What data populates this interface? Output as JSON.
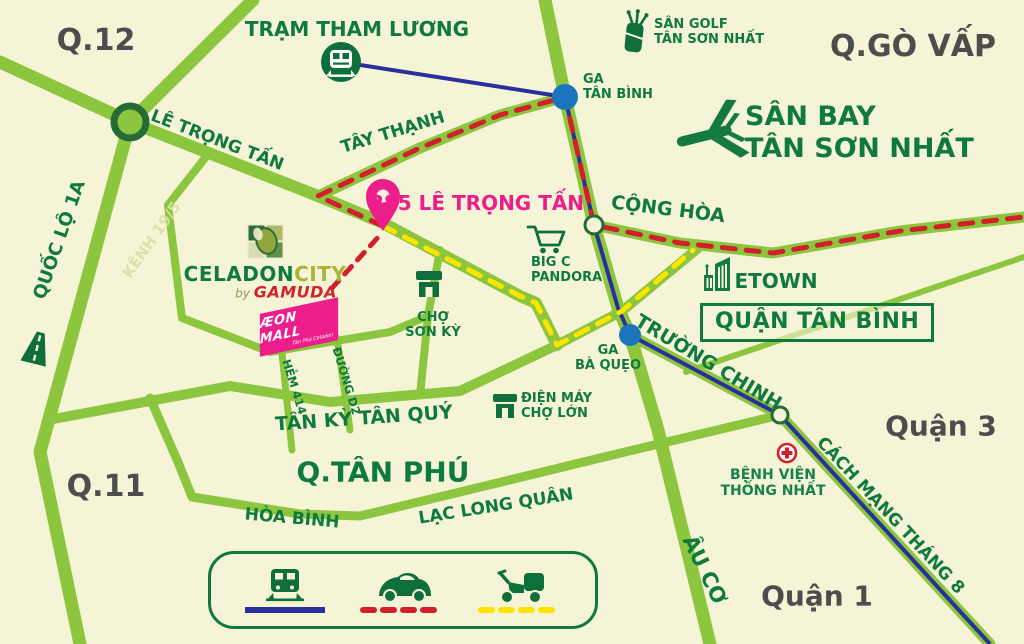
{
  "colors": {
    "background": "#f6f4d6",
    "road": "#8cc63e",
    "road_ring": "#256b35",
    "green_text": "#0f7a3d",
    "olive": "#a8b43a",
    "gray_text": "#4d4d4d",
    "magenta": "#ec1e8c",
    "route_red": "#d1202c",
    "route_yellow": "#ffe400",
    "route_navy": "#2b2f9c",
    "station_blue": "#1b75bc"
  },
  "districts": {
    "q12": "Q.12",
    "go_vap": "Q.GÒ VẤP",
    "tan_binh": "QUẬN TÂN BÌNH",
    "quan3": "Quận 3",
    "quan1": "Quận 1",
    "q11": "Q.11",
    "tan_phu": "Q.TÂN PHÚ"
  },
  "roads": {
    "le_trong_tan": "LÊ TRỌNG TẤN",
    "tay_thanh": "TÂY THẠNH",
    "quoc_lo_1a": "QUỐC LỘ 1A",
    "kenh_19_5": "KÊNH 19/5",
    "cong_hoa": "CỘNG HÒA",
    "truong_chinh": "TRƯỜNG CHINH",
    "tan_ky_tan_quy": "TÂN KỲ TÂN QUÝ",
    "hem_414": "HẺM 414",
    "duong_d2": "ĐƯỜNG D2",
    "hoa_binh": "HÒA BÌNH",
    "lac_long_quan": "LẠC LONG QUÂN",
    "au_co": "ÂU CƠ",
    "cach_mang_thang_8": "CÁCH MẠNG THÁNG 8"
  },
  "stations": {
    "tram_tham_luong": "TRẠM THAM LƯƠNG",
    "ga_tan_binh_line1": "GA",
    "ga_tan_binh_line2": "TÂN BÌNH",
    "ga_ba_queo_line1": "GA",
    "ga_ba_queo_line2": "BÀ QUẸO"
  },
  "landmarks": {
    "san_golf_line1": "SÂN GOLF",
    "san_golf_line2": "TÂN SƠN NHẤT",
    "san_bay_line1": "SÂN BAY",
    "san_bay_line2": "TÂN SƠN NHẤT",
    "big_c_line1": "BIG C",
    "big_c_line2": "PANDORA",
    "cho_son_ky_line1": "CHỢ",
    "cho_son_ky_line2": "SƠN KỲ",
    "etown": "ETOWN",
    "dien_may_line1": "ĐIỆN MÁY",
    "dien_may_line2": "CHỢ LỚN",
    "benh_vien_line1": "BỆNH VIỆN",
    "benh_vien_line2": "THỐNG NHẤT"
  },
  "project": {
    "address": "285 LÊ TRỌNG TẤN",
    "name_main": "CELADON",
    "name_accent": "CITY",
    "by": "by",
    "developer": "GAMUDA",
    "mall_name": "ÆON MALL",
    "mall_sub": "Tân Phú Celadon"
  },
  "legend": {
    "items": [
      {
        "icon": "train-icon",
        "line_style": "solid",
        "line_color": "#2b2f9c"
      },
      {
        "icon": "car-icon",
        "line_style": "dashed",
        "line_color": "#d1202c"
      },
      {
        "icon": "scooter-icon",
        "line_style": "dashed",
        "line_color": "#ffe400"
      }
    ]
  }
}
